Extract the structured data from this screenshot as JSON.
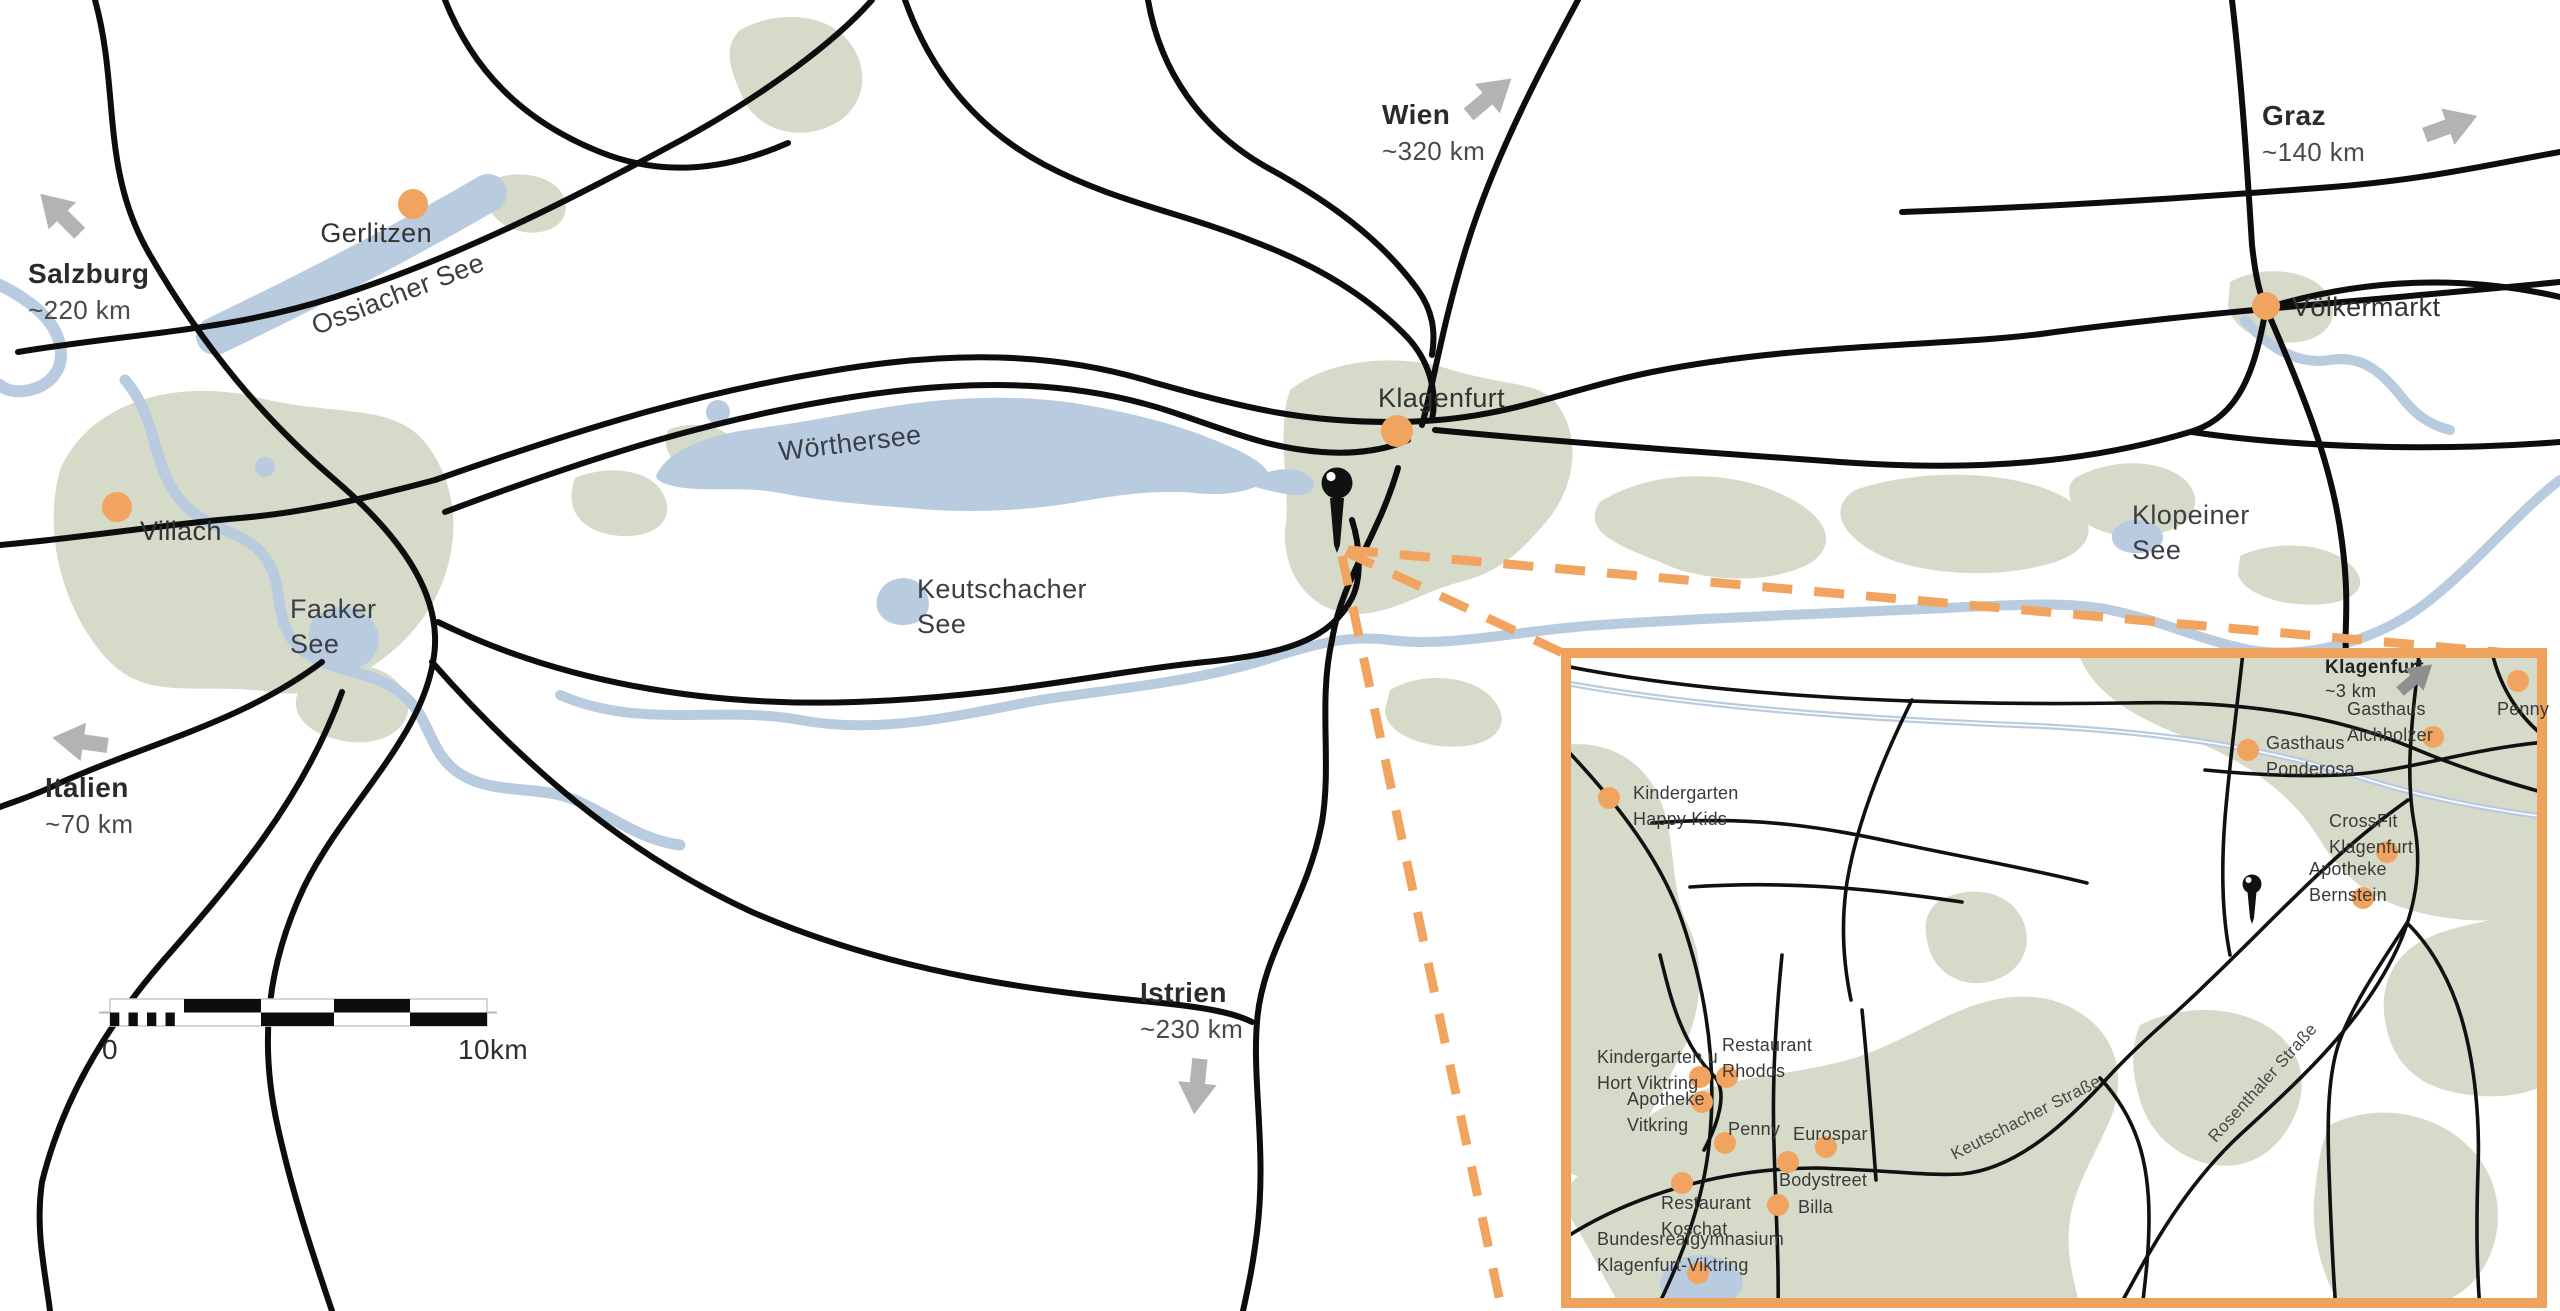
{
  "colors": {
    "accent": "#F1A45F",
    "water": "#B9CBDF",
    "land": "#D6DAC8",
    "road": "#0D0D0D",
    "arrow_gray": "#B3B3B3",
    "arrow_dark_gray": "#8F8F8F",
    "text": "#333333"
  },
  "main_map": {
    "cities": [
      {
        "name": "Gerlitzen",
        "dot": {
          "x": 413,
          "y": 204,
          "r": 15
        },
        "label": {
          "x": 432,
          "y": 216,
          "anchor": "right"
        }
      },
      {
        "name": "Villach",
        "dot": {
          "x": 117,
          "y": 507,
          "r": 15
        },
        "label": {
          "x": 140,
          "y": 514,
          "anchor": "left"
        }
      },
      {
        "name": "Klagenfurt",
        "dot": {
          "x": 1397,
          "y": 431,
          "r": 16
        },
        "label": {
          "x": 1378,
          "y": 381,
          "anchor": "left"
        }
      },
      {
        "name": "Völkermarkt",
        "dot": {
          "x": 2266,
          "y": 306,
          "r": 14
        },
        "label": {
          "x": 2292,
          "y": 290,
          "anchor": "left"
        }
      }
    ],
    "lakes": [
      {
        "name": "Ossiacher See",
        "x": 398,
        "y": 277,
        "anchor": "center",
        "rotate": -21
      },
      {
        "name": "Wörthersee",
        "x": 850,
        "y": 426,
        "anchor": "center",
        "rotate": -7
      },
      {
        "name": "Faaker\nSee",
        "x": 290,
        "y": 592,
        "anchor": "left",
        "rotate": 0
      },
      {
        "name": "Keutschacher\nSee",
        "x": 917,
        "y": 572,
        "anchor": "left",
        "rotate": 0
      },
      {
        "name": "Klopeiner\nSee",
        "x": 2132,
        "y": 498,
        "anchor": "left",
        "rotate": 0
      }
    ],
    "directions": [
      {
        "name": "Salzburg",
        "distance": "~220 km",
        "label": {
          "x": 28,
          "y": 256
        },
        "arrow": {
          "cx": 60,
          "cy": 213,
          "len": 56,
          "rotate": -135
        }
      },
      {
        "name": "Wien",
        "distance": "~320 km",
        "label": {
          "x": 1382,
          "y": 97
        },
        "arrow": {
          "cx": 1490,
          "cy": 96,
          "len": 56,
          "rotate": -40
        }
      },
      {
        "name": "Graz",
        "distance": "~140 km",
        "label": {
          "x": 2262,
          "y": 98
        },
        "arrow": {
          "cx": 2451,
          "cy": 125,
          "len": 56,
          "rotate": -20
        }
      },
      {
        "name": "Italien",
        "distance": "~70 km",
        "label": {
          "x": 45,
          "y": 770
        },
        "arrow": {
          "cx": 80,
          "cy": 741,
          "len": 56,
          "rotate": 188
        }
      },
      {
        "name": "Istrien",
        "distance": "~230 km",
        "label": {
          "x": 1140,
          "y": 975
        },
        "arrow": {
          "cx": 1197,
          "cy": 1086,
          "len": 56,
          "rotate": 96
        }
      }
    ],
    "scale_bar": {
      "start_label": "0",
      "end_label": "10km"
    }
  },
  "inset": {
    "heading": {
      "name": "Klagenfurt",
      "distance": "~3 km",
      "label": {
        "x": 2325,
        "y": 655
      },
      "arrow": {
        "cx": 2416,
        "cy": 678,
        "len": 42,
        "rotate": -40
      }
    },
    "pois": [
      {
        "name": "Kindergarten\nHappy Kids",
        "dot": {
          "x": 1609,
          "y": 798
        },
        "label": {
          "x": 1633,
          "y": 780,
          "anchor": "left"
        }
      },
      {
        "name": "Gasthaus\nPonderosa",
        "dot": {
          "x": 2248,
          "y": 750
        },
        "label": {
          "x": 2266,
          "y": 730,
          "anchor": "left"
        }
      },
      {
        "name": "Gasthaus\nAichholzer",
        "dot": {
          "x": 2433,
          "y": 737
        },
        "label": {
          "x": 2347,
          "y": 696,
          "anchor": "left"
        }
      },
      {
        "name": "Penny",
        "dot": {
          "x": 2518,
          "y": 681
        },
        "label": {
          "x": 2497,
          "y": 696,
          "anchor": "left"
        }
      },
      {
        "name": "CrossFit\nKlagenfurt",
        "dot": {
          "x": 2387,
          "y": 852
        },
        "label": {
          "x": 2329,
          "y": 808,
          "anchor": "left"
        }
      },
      {
        "name": "Apotheke\nBernstein",
        "dot": {
          "x": 2363,
          "y": 898
        },
        "label": {
          "x": 2309,
          "y": 856,
          "anchor": "left"
        }
      },
      {
        "name": "Kindergarten u\nHort Viktring",
        "dot": {
          "x": 1700,
          "y": 1077
        },
        "label": {
          "x": 1597,
          "y": 1044,
          "anchor": "left"
        }
      },
      {
        "name": "Restaurant\nRhodos",
        "dot": {
          "x": 1727,
          "y": 1077
        },
        "label": {
          "x": 1722,
          "y": 1032,
          "anchor": "left"
        }
      },
      {
        "name": "Apotheke\nVitkring",
        "dot": {
          "x": 1702,
          "y": 1102
        },
        "label": {
          "x": 1627,
          "y": 1086,
          "anchor": "left"
        }
      },
      {
        "name": "Penny",
        "dot": {
          "x": 1725,
          "y": 1143
        },
        "label": {
          "x": 1728,
          "y": 1116,
          "anchor": "left"
        }
      },
      {
        "name": "Eurospar",
        "dot": {
          "x": 1826,
          "y": 1147
        },
        "label": {
          "x": 1793,
          "y": 1121,
          "anchor": "left"
        }
      },
      {
        "name": "Bodystreet",
        "dot": {
          "x": 1788,
          "y": 1162
        },
        "label": {
          "x": 1779,
          "y": 1167,
          "anchor": "left"
        }
      },
      {
        "name": "Billa",
        "dot": {
          "x": 1778,
          "y": 1205
        },
        "label": {
          "x": 1798,
          "y": 1194,
          "anchor": "left"
        }
      },
      {
        "name": "Restaurant\nKoschat",
        "dot": {
          "x": 1682,
          "y": 1183
        },
        "label": {
          "x": 1661,
          "y": 1190,
          "anchor": "left"
        }
      },
      {
        "name": "Bundesrealgymnasium\nKlagenfurt-Viktring",
        "dot": {
          "x": 1698,
          "y": 1273
        },
        "label": {
          "x": 1597,
          "y": 1226,
          "anchor": "left"
        }
      }
    ],
    "streets": [
      {
        "name": "Keutschacher Straße",
        "x": 2026,
        "y": 1118,
        "rotate": -27
      },
      {
        "name": "Rosenthaler Straße",
        "x": 2263,
        "y": 1083,
        "rotate": -48
      }
    ]
  }
}
